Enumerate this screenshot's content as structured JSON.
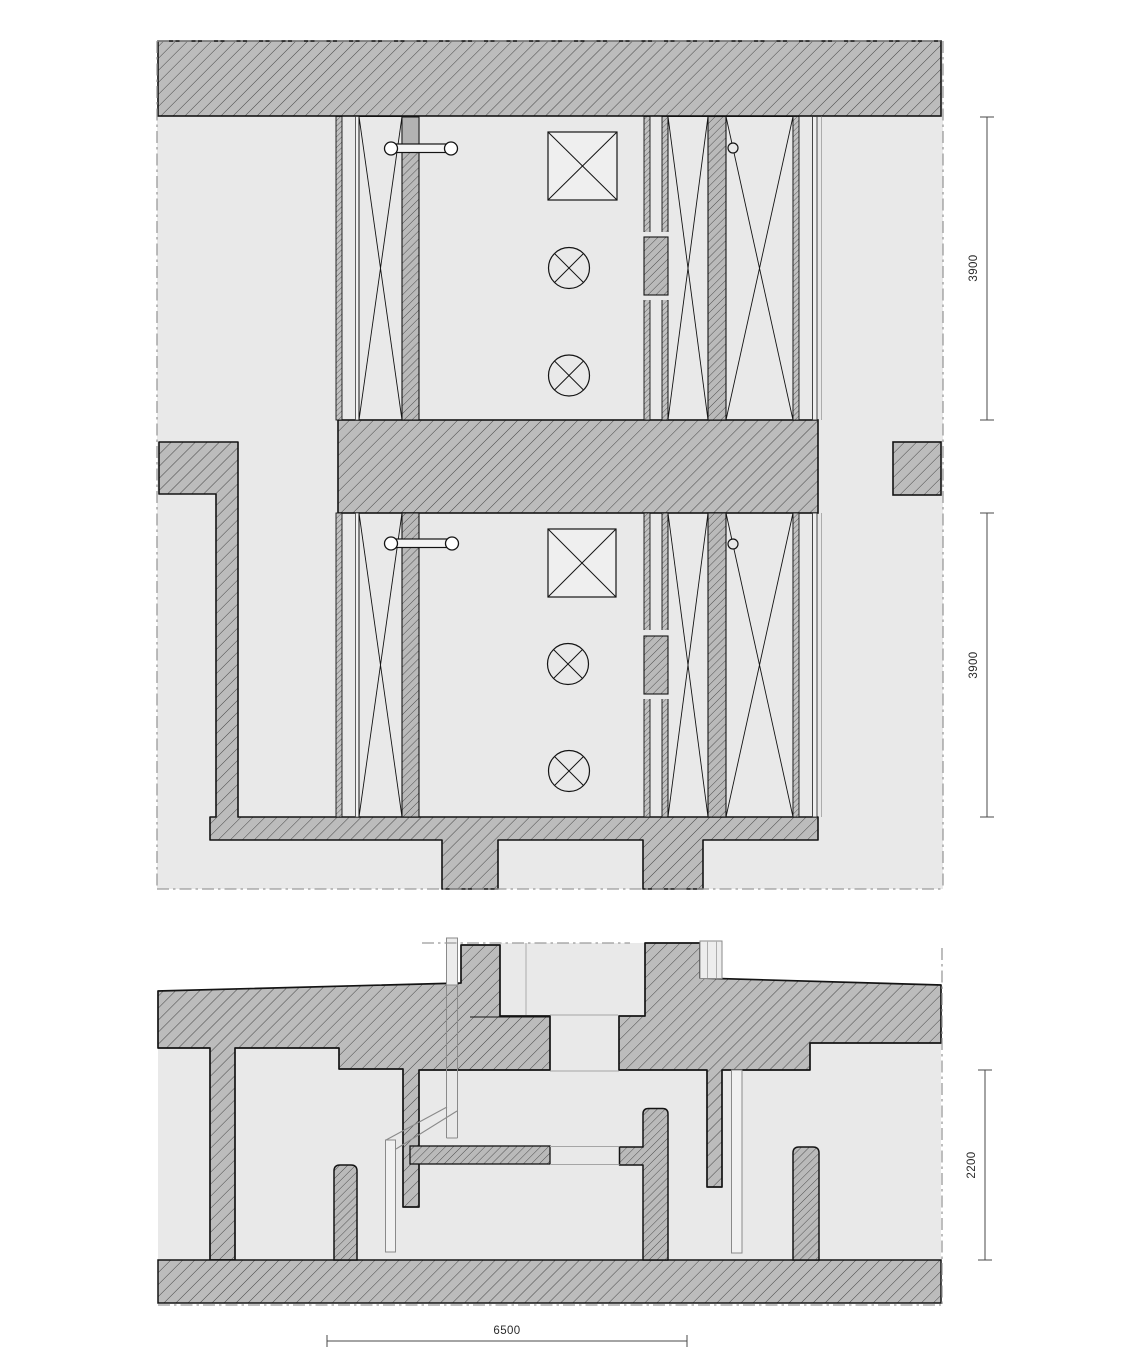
{
  "drawing": {
    "kind": "architectural detail drawing",
    "views": {
      "plan": "timber frame wall plan detail",
      "section": "vertical section detail"
    }
  },
  "dimensions": {
    "plan_upper": "3900",
    "plan_lower": "3900",
    "section_height": "2200",
    "section_span": "6500"
  },
  "symbols": {
    "crossed_square": "junction-box-symbol",
    "crossed_circle": "luminaire-symbol",
    "dowel_bar": "anchor-fixing-symbol",
    "x_panel": "insulated-frame-panel"
  },
  "colors": {
    "paper": "#ffffff",
    "space_fill": "#e9e9e9",
    "wall_fill": "#bcbcbc",
    "hatch_line": "#474747",
    "outline": "#141414",
    "boundary_line": "#9a9a9a",
    "dimension_line": "#4a4a4a"
  }
}
